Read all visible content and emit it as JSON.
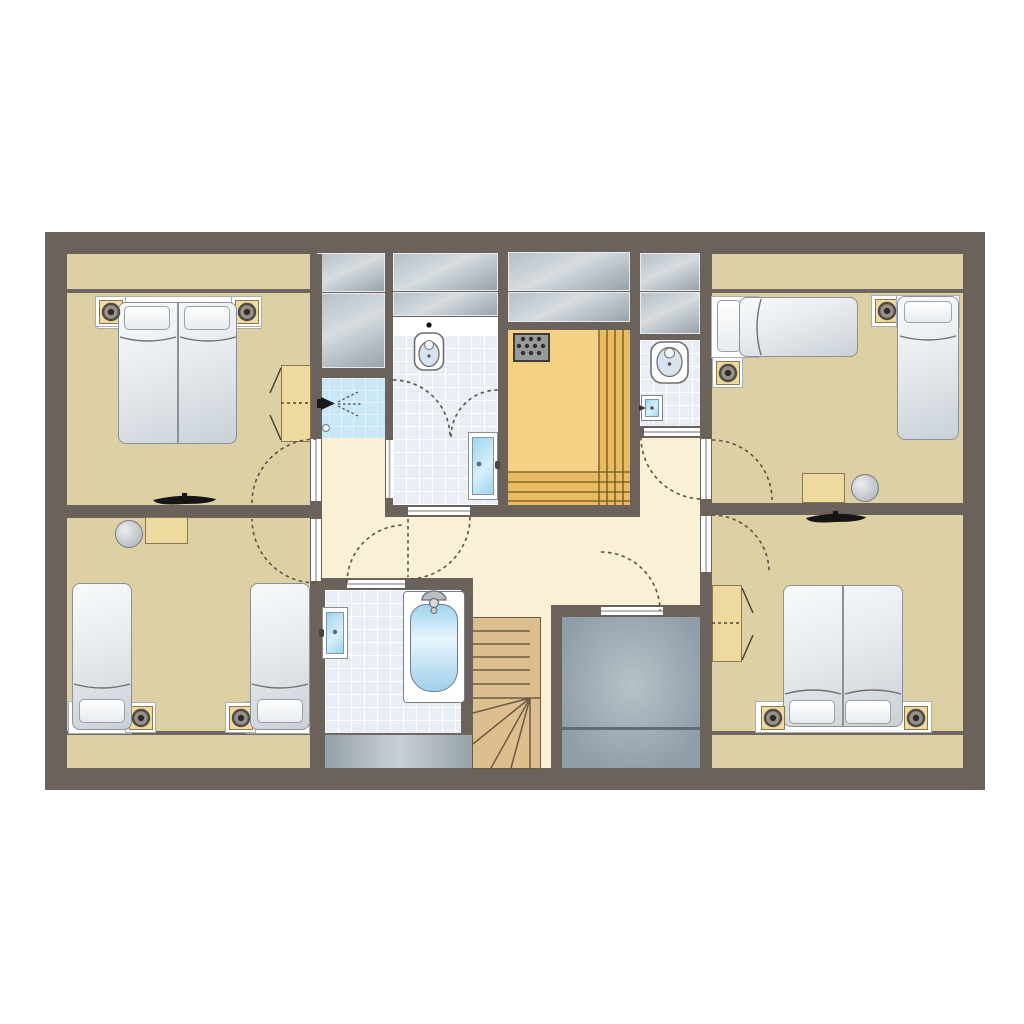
{
  "scene": {
    "kind": "floor-plan",
    "view": "top-down architectural plan",
    "has_text": false,
    "floor_shape": "rectangle"
  },
  "palette": {
    "page_bg": "#ffffff",
    "wall": "#6b625c",
    "bedroom_floor": "#dcd0a4",
    "hall_floor": "#faf0d5",
    "tile_floor": "#e9edf6",
    "tile_grid": "#ffffff",
    "shower_floor": "#c9e7f7",
    "sauna_floor": "#f4d184",
    "sauna_bench": "#e9bc64",
    "sauna_line": "#6d571f",
    "wood": "#eeda9f",
    "wood_border": "#8a7850",
    "stairs_wood": "#dcbe8f",
    "stairs_line": "#6b5b43",
    "sky1": "#b6bfc6",
    "sky2": "#d6dce0",
    "sky3": "#97a2aa",
    "storage1": "#b7c2c8",
    "storage2": "#8f9da7",
    "strip1": "#95a0a8",
    "strip2": "#c9d1d6",
    "bed1": "#f8fafb",
    "bed2": "#c9d1d7",
    "bed_border": "#8c9196",
    "pillow_border": "#9aa0a5",
    "glass1": "#9fd4f0",
    "glass2": "#d8effb",
    "white": "#ffffff",
    "threshold_line": "#b9b9b9",
    "knee_line": "#6f665f",
    "arc_color": "#5b524a",
    "lamp_ring": "#97918a",
    "lamp_ring_border": "#514b45",
    "lamp_dot": "#2f2b28",
    "fixture_line": "#6e6e6e"
  },
  "rooms": [
    {
      "id": "bedroom-top-left",
      "type": "bedroom",
      "furniture": [
        "double-bed",
        "nightstand-lamp",
        "nightstand-lamp",
        "wardrobe",
        "radiator"
      ]
    },
    {
      "id": "bedroom-top-right",
      "type": "bedroom",
      "furniture": [
        "single-bed",
        "single-bed",
        "nightstand-lamp",
        "nightstand-lamp",
        "desk",
        "stool"
      ]
    },
    {
      "id": "bedroom-bottom-left",
      "type": "bedroom",
      "furniture": [
        "single-bed",
        "single-bed",
        "nightstand-lamp",
        "nightstand-lamp",
        "desk",
        "stool"
      ]
    },
    {
      "id": "bedroom-bottom-right",
      "type": "bedroom",
      "furniture": [
        "double-bed",
        "nightstand-lamp",
        "nightstand-lamp",
        "wardrobe",
        "radiator"
      ]
    },
    {
      "id": "bathroom-top",
      "type": "bathroom",
      "furniture": [
        "toilet",
        "counter",
        "glass-door-to-sauna"
      ]
    },
    {
      "id": "shower-cabin",
      "type": "shower",
      "furniture": [
        "shower-head",
        "drain"
      ]
    },
    {
      "id": "sauna",
      "type": "sauna",
      "furniture": [
        "sauna-heater",
        "benches"
      ]
    },
    {
      "id": "wc",
      "type": "toilet-room",
      "furniture": [
        "toilet",
        "washbasin"
      ]
    },
    {
      "id": "bathroom-bottom",
      "type": "bathroom",
      "furniture": [
        "bathtub",
        "shower-mixer",
        "glass-door"
      ]
    },
    {
      "id": "hallway",
      "type": "hall",
      "furniture": [
        "door-swing-arcs"
      ]
    },
    {
      "id": "staircase",
      "type": "stairs",
      "furniture": [
        "winder-steps"
      ]
    },
    {
      "id": "storage-room",
      "type": "storage",
      "furniture": []
    },
    {
      "id": "eaves-closets",
      "type": "built-in-storage",
      "furniture": [
        "skylight-gray-blocks"
      ]
    }
  ]
}
